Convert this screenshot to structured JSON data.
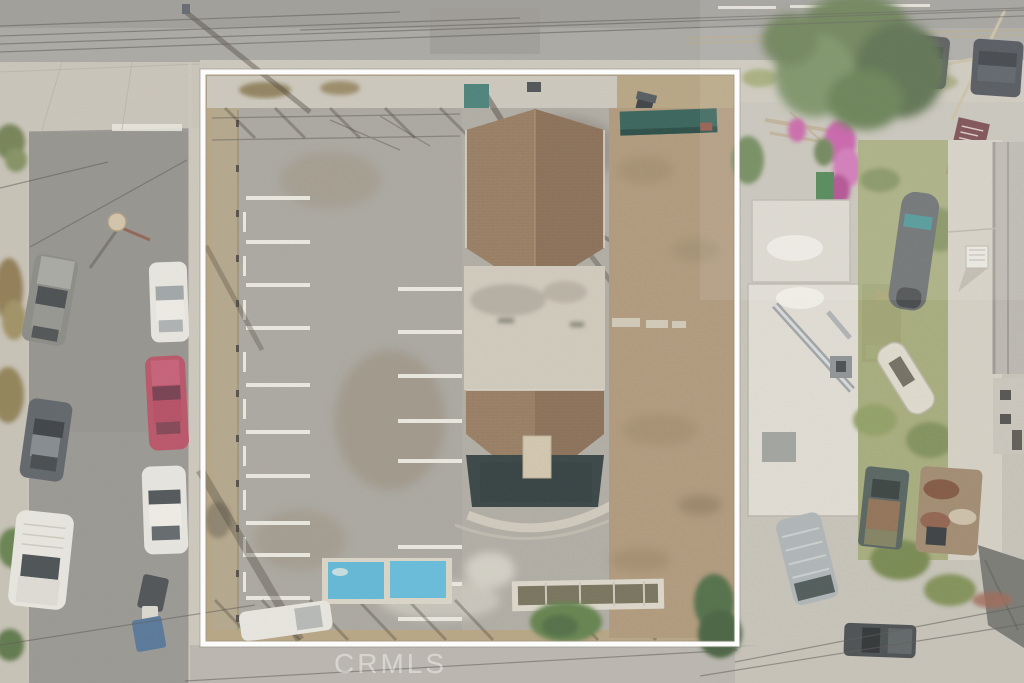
{
  "image": {
    "alt": "Hazy aerial drone photo of a vacant fenced commercial parking lot with a brown-roofed building, outlined by a white property boundary, surrounded by streets, parked cars and neighboring houses"
  },
  "watermark": {
    "text": "CRMLS"
  },
  "boundary": {
    "color": "#ffffff"
  },
  "palette": {
    "base": "#c3bfb4",
    "road": "#a5a39e",
    "road-dark": "#9a9893",
    "street": "#93918b",
    "sidewalk": "#c9c4b8",
    "intersection": "#c6c1b5",
    "lot": "#a5a29a",
    "lot-stain": "#8f7f68",
    "dirt": "#ab9374",
    "dirt-dark": "#93805e",
    "dirt-light": "#b3a07c",
    "stripe": "#e9e6dd",
    "roof-left": "#93775a",
    "roof-right": "#85684e",
    "roof-line": "#5f4a36",
    "courtyard": "#cdc6b8",
    "dark-roof": "#2b3839",
    "teal": "#2b5a50",
    "white-roof": "#dedad1",
    "shed-brown": "#7e6853",
    "grass": "#9da46e",
    "grass-dark": "#7a8a52",
    "tree": "#5d7547",
    "tree-dark": "#49613a",
    "bougainvillea": "#c250a0",
    "sign-maroon": "#6e3a40",
    "boundary": "#ffffff",
    "watermark": "rgba(255,255,255,0.55)",
    "car-white": "#e6e4dd",
    "car-red": "#b5495f",
    "car-gray": "#83847e",
    "car-dark": "#555b60",
    "van-silver": "#aab0b2",
    "truck-dark": "#3f4446",
    "blue-paint": "#57b3d3",
    "planter": "#d9d4c6",
    "shadow": "#3a342a",
    "wire": "#55514b",
    "glass": "#3f4649"
  },
  "generated": {
    "left_stripes": {
      "x": 246,
      "w": 64,
      "h": 4,
      "ys": [
        196,
        240,
        283,
        326,
        383,
        430,
        474,
        521,
        553,
        596
      ]
    },
    "right_stripes": {
      "x": 398,
      "w": 64,
      "h": 4,
      "ys": [
        287,
        330,
        374,
        419,
        459,
        545,
        582,
        617
      ]
    },
    "wheel_stops": {
      "x": 243,
      "w": 3,
      "h": 20,
      "ys": [
        212,
        256,
        300,
        352,
        399,
        446,
        490,
        537,
        572
      ]
    },
    "fence_posts": {
      "x": 236,
      "w": 3,
      "h": 7,
      "ys": [
        120,
        165,
        210,
        255,
        300,
        345,
        390,
        435,
        480,
        525,
        570,
        615
      ]
    },
    "bottom_braces": {
      "y": 600,
      "len": 38,
      "xs": [
        215,
        262,
        310,
        358,
        408,
        455,
        560,
        618
      ]
    },
    "top_braces": {
      "y": 108,
      "len": 30,
      "xs": [
        225,
        275,
        330,
        385,
        440
      ]
    }
  }
}
